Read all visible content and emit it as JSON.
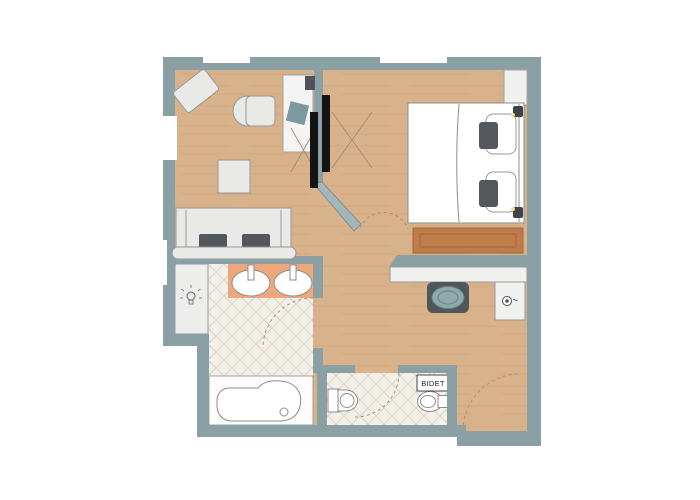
{
  "plan": {
    "title": "studio-apartment-floor-plan",
    "labels": {
      "bidet": "BIDET"
    },
    "rooms": [
      "living-room",
      "bedroom",
      "hallway",
      "dressing-nook",
      "bathroom",
      "wc",
      "entry"
    ],
    "furniture": [
      {
        "name": "angled-armchair",
        "room": "living-room"
      },
      {
        "name": "desk",
        "room": "living-room"
      },
      {
        "name": "desk-chair",
        "room": "living-room"
      },
      {
        "name": "monitor",
        "room": "living-room"
      },
      {
        "name": "laptop",
        "room": "living-room"
      },
      {
        "name": "side-table",
        "room": "living-room"
      },
      {
        "name": "sofa-two-cushions",
        "room": "living-room"
      },
      {
        "name": "tv-living-side",
        "room": "living-room"
      },
      {
        "name": "tv-bedroom-side",
        "room": "bedroom"
      },
      {
        "name": "double-bed-two-pillows",
        "room": "bedroom"
      },
      {
        "name": "reading-lamp-top",
        "room": "bedroom"
      },
      {
        "name": "reading-lamp-bottom",
        "room": "bedroom"
      },
      {
        "name": "wardrobe",
        "room": "bedroom"
      },
      {
        "name": "wooden-bench",
        "room": "bedroom"
      },
      {
        "name": "console-desk",
        "room": "dressing-nook"
      },
      {
        "name": "stool",
        "room": "dressing-nook"
      },
      {
        "name": "hairdryer",
        "room": "dressing-nook"
      },
      {
        "name": "vanity-two-sinks",
        "room": "bathroom"
      },
      {
        "name": "light-niche",
        "room": "bathroom"
      },
      {
        "name": "bathtub",
        "room": "bathroom"
      },
      {
        "name": "toilet",
        "room": "wc"
      },
      {
        "name": "bidet",
        "room": "wc"
      }
    ]
  },
  "colors": {
    "wall": "#8ba0a5",
    "wall_light": "#a3b6b9",
    "wall_edge": "#74888d",
    "wood": "#d8b28b",
    "wood_grain": "#c49a6e",
    "tile": "#f3f0ea",
    "tile_line": "#d9d2c5",
    "furniture": "#e9e9e7",
    "furniture_edge": "#97979b",
    "fixture_edge": "#8d8d8b",
    "cushion": "#54575b",
    "tv": "#141414",
    "laptop": "#7d98a1",
    "monitor": "#4f5358",
    "bench": "#c07c4a",
    "bench_edge": "#a2693c",
    "counter": "#efa87c",
    "niche": "#ededeb",
    "console": "#f0f0ee",
    "stool_base": "#50565a",
    "stool_top": "#8fa9ac",
    "stool_top_edge": "#6a8286",
    "deck": "#fcfcfa",
    "dash": "#a59483",
    "line_x": "#9b8876",
    "glint": "#f2e48c",
    "label_text": "#222222"
  }
}
